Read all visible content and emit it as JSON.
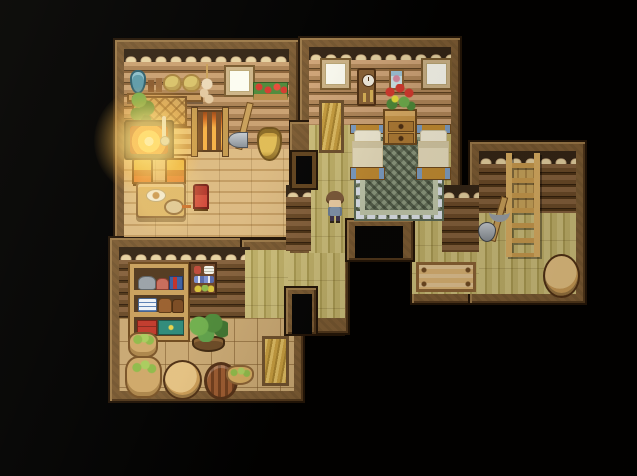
{
  "scene": {
    "type": "pixel-art top-down house interior (RPG style)",
    "caption": "Pixel-art interior map of a wooden house: a kitchen with a glowing hearth, a bedroom with twin beds and a zigzag rug, a pantry full of goods, and a storage room with a wall ladder, all joined by bamboo-floored hallways. A player character stands in the hallway outside the bedroom.",
    "background": "#000000"
  },
  "palette": {
    "bg": "#000000",
    "frame": "#7d5c34",
    "frame_edge": "#231508",
    "frame_hi": "#9c7a4a",
    "frame_lo": "#4f361b",
    "plates_bg": "#342516",
    "plate": "#e6d2a2",
    "plate_shadow": "#b2916a",
    "log_light_a": "#c9a071",
    "log_light_b": "#ab8255",
    "log_light_c": "#8a6238",
    "log_seam": "#5e4222",
    "log_mid_a": "#cfa478",
    "log_mid_b": "#b1875a",
    "log_mid_c": "#8f683e",
    "log_dark_a": "#84603c",
    "log_dark_b": "#6a4a28",
    "log_dark_c": "#4e3417",
    "log_dark_seam": "#33200d",
    "wood_a": "#dcba82",
    "wood_b": "#c39c62",
    "bamboo_a": "#ccbe7b",
    "bamboo_b": "#aa9b53",
    "bamboo_c": "#bfb069",
    "tile": "#c9a873",
    "rug_field": "#8d9a80",
    "rug_zig": "#4f5a45",
    "rug_trim": "#dfe5ec",
    "rug_inner": "#c2c9ad",
    "bed_wood": "#c28c32",
    "bed_blanket": "#e9dfbf",
    "bed_pillow": "#f4eed8",
    "bed_trim": "#7e9fc5",
    "hay_a": "#dcba61",
    "hay_b": "#c59c3f",
    "hay_c": "#a8832f",
    "fire_core": "#fff8cf",
    "fire_mid": "#ffd257",
    "fire_out": "#f49b2e",
    "leaf": "#4e8a3a",
    "leaf_light": "#6fae4d",
    "flower_red": "#d63a2f",
    "teal": "#5e9aa8",
    "metal": "#9aa1a8",
    "char_hair": "#7d5a3b",
    "char_face": "#f0d0a6",
    "char_shirt": "#8295ac",
    "char_pants": "#40364e"
  },
  "rooms": {
    "kitchen": {
      "label": "Kitchen and hearth room"
    },
    "bedroom": {
      "label": "Bedroom with twin beds"
    },
    "pantry": {
      "label": "Pantry storeroom"
    },
    "storage": {
      "label": "Storage room with ladder"
    },
    "hallway": {
      "label": "Bamboo hallway"
    },
    "annex": {
      "label": "Storage annex"
    }
  },
  "objects": {
    "shelf_board": {
      "label": "Wall shelf"
    },
    "jug": {
      "label": "Blue jug"
    },
    "mugs": {
      "label": "Mugs"
    },
    "bread_left": {
      "label": "Bread loaf"
    },
    "bread_right": {
      "label": "Bread loaf"
    },
    "garlic": {
      "label": "Hanging garlic strand"
    },
    "kitchen_window": {
      "label": "Window"
    },
    "flower_box": {
      "label": "Flower box"
    },
    "counter": {
      "label": "Work counter"
    },
    "vine": {
      "label": "Hanging vine plant"
    },
    "hearth": {
      "label": "Hearth fire"
    },
    "ladle": {
      "label": "Ladle"
    },
    "wood_pile": {
      "label": "Stacked firewood"
    },
    "fire_grate": {
      "label": "Fire grate screen"
    },
    "axe": {
      "label": "Axe leaning on wall"
    },
    "clay_jar": {
      "label": "Clay jar"
    },
    "chair_left": {
      "label": "Chair"
    },
    "chair_right": {
      "label": "Chair"
    },
    "dining_table": {
      "label": "Dining table with meal"
    },
    "red_chair": {
      "label": "Small red chair"
    },
    "pantry_shelf": {
      "label": "Pantry shelf with goods"
    },
    "wall_shelf": {
      "label": "Wall shelf with preserves"
    },
    "veggie_planter": {
      "label": "Planter of leafy greens"
    },
    "sack_small": {
      "label": "Sack of produce"
    },
    "sack_large": {
      "label": "Sack of produce"
    },
    "pantry_barrel": {
      "label": "Barrel"
    },
    "woven_basket": {
      "label": "Woven basket"
    },
    "fruit_basket": {
      "label": "Basket of fruit"
    },
    "hay_nook": {
      "label": "Hay nook"
    },
    "bedroom_window_left": {
      "label": "Window"
    },
    "bedroom_window_right": {
      "label": "Window"
    },
    "cuckoo_clock": {
      "label": "Cuckoo clock"
    },
    "wall_picture": {
      "label": "Framed picture"
    },
    "dresser": {
      "label": "Dresser"
    },
    "flower_vase": {
      "label": "Vase of red flowers"
    },
    "bed_left": {
      "label": "Bed"
    },
    "bed_right": {
      "label": "Bed"
    },
    "rug": {
      "label": "Zigzag rug"
    },
    "bedroom_door": {
      "label": "Wooden door"
    },
    "kitchen_doorway": {
      "label": "Doorway to kitchen"
    },
    "south_doorway": {
      "label": "South doorway"
    },
    "hall_doorway": {
      "label": "Hall doorway"
    },
    "ladder": {
      "label": "Wall ladder"
    },
    "mining_tools": {
      "label": "Shovel and pickaxe"
    },
    "storage_barrel": {
      "label": "Barrel"
    },
    "storage_crate": {
      "label": "Wooden crate"
    },
    "player": {
      "label": "Player character"
    }
  }
}
